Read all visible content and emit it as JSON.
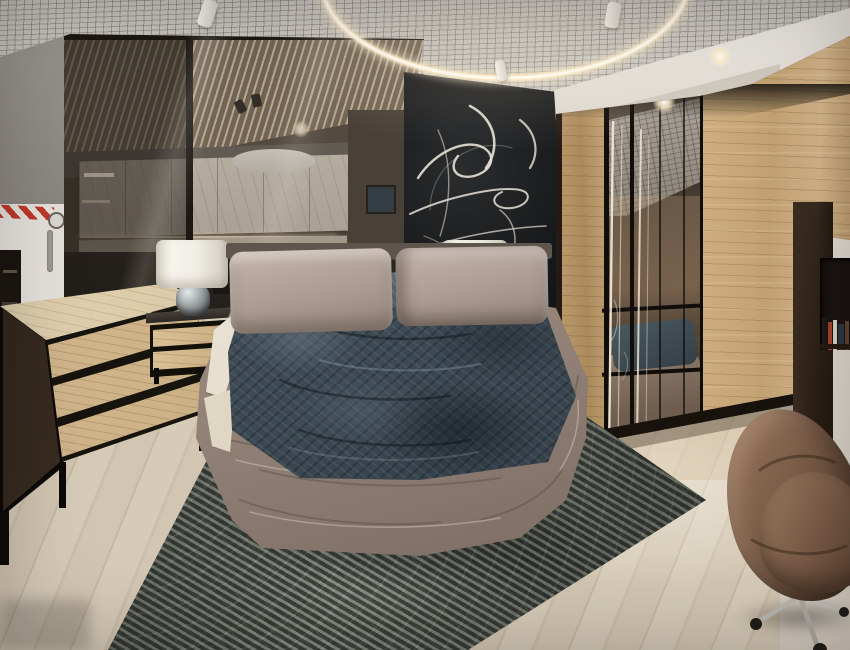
{
  "meta": {
    "description": "Photograph of a bedroom furniture showroom display",
    "setting": "furniture store bedroom exhibit",
    "no_visible_text": true
  },
  "objects": {
    "ceiling": {
      "label": "open-cell grid ceiling",
      "color": "#c9c6c1"
    },
    "ring_light": {
      "label": "circular LED pendant light",
      "color": "#fff3d8"
    },
    "spotlights": {
      "label": "white track spotlights",
      "count": 3
    },
    "glass_partition": {
      "label": "tinted glass partition with kitchen display behind",
      "frame_color": "#0f0d0b"
    },
    "kitchen_display": {
      "label": "cream marble kitchen cabinets with dark counter",
      "cabinet_color": "#d9d1c5"
    },
    "black_wall": {
      "label": "black accent wall with white calligraphy mural",
      "color": "#17181a",
      "script_color": "#e7e1d6"
    },
    "wardrobe": {
      "label": "oak wardrobe with smoked mirror sliding doors",
      "wood_color": "#c9a878",
      "mirror_color": "#41382e"
    },
    "bookshelf": {
      "label": "dark bookcase with books",
      "color": "#33281e"
    },
    "bed": {
      "label": "taupe upholstered low bed",
      "frame_color": "#9b8b81",
      "cushion_color": "#b6a79d"
    },
    "duvet": {
      "label": "dark teal patterned duvet",
      "color": "#44505a"
    },
    "pillows": {
      "label": "two slate blue textured pillows",
      "color": "#4b5a66"
    },
    "sheet": {
      "label": "cream bed sheet",
      "color": "#ece3d4"
    },
    "nightstands": {
      "label": "two oak nightstands with black frames",
      "count": 2,
      "wood_color": "#d3b88e"
    },
    "lamps": {
      "label": "glass urn table lamps with white drum shades",
      "count": 2,
      "shade_color": "#f2efe8"
    },
    "dresser": {
      "label": "oak dresser with smoked glass side",
      "wood_color": "#ccb188"
    },
    "rug": {
      "label": "distressed grey oriental rug",
      "color": "#4c504b"
    },
    "floor": {
      "label": "light oak plank flooring",
      "color": "#d3c8b6"
    },
    "chair": {
      "label": "brown velvet swivel egg chair with chrome base",
      "color": "#7b5d48"
    },
    "door": {
      "label": "white service door with hazard tape",
      "color": "#e9e6e0",
      "tape_color": "#c0392b"
    },
    "wall_left": {
      "label": "grey wall",
      "color": "#908d89"
    },
    "wall_right": {
      "label": "white wall",
      "color": "#e8e3db"
    }
  },
  "palette": {
    "accent_wood": "#c9a878",
    "accent_dark": "#17181a",
    "textile_teal": "#44505a",
    "textile_taupe": "#9b8b81",
    "light_warm": "#fff3d8"
  }
}
